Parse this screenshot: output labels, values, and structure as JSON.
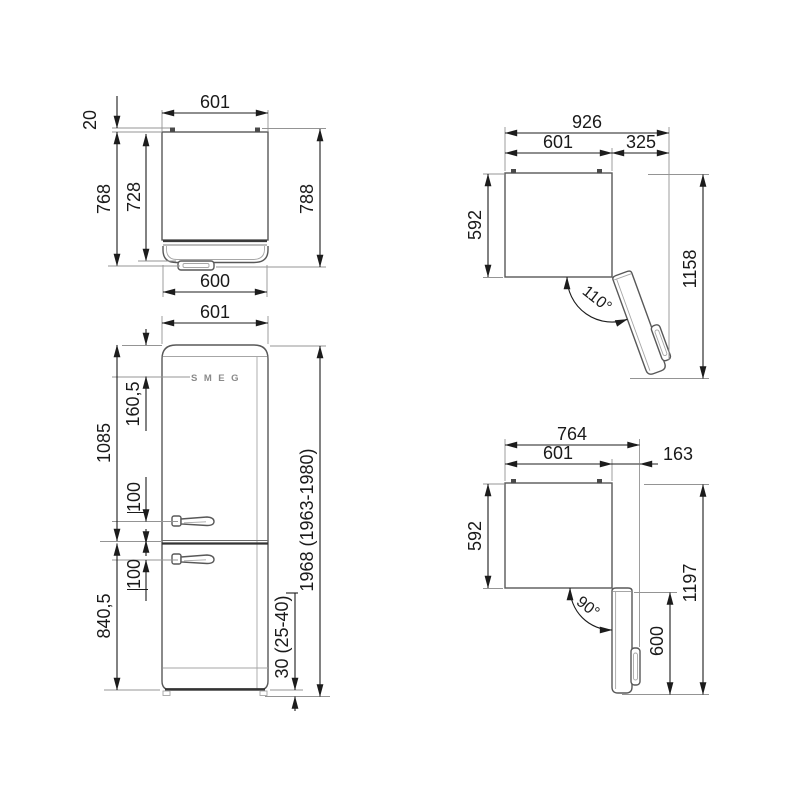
{
  "brand": "SMEG",
  "views": {
    "top": {
      "width_top": "601",
      "hinge_depth": "20",
      "depth_body": "768",
      "depth_inner": "728",
      "depth_total": "788",
      "width_bottom": "600"
    },
    "front": {
      "width": "601",
      "logo_offset": "160,5",
      "upper_section_height": "1085",
      "handle_offset_upper": "100",
      "handle_offset_lower": "100",
      "lower_section_height": "840,5",
      "plinth_height": "30 (25-40)",
      "total_height": "1968 (1963-1980)"
    },
    "door_110": {
      "total_width": "926",
      "body_width": "601",
      "door_clearance": "325",
      "body_depth": "592",
      "total_depth": "1158",
      "angle": "110°"
    },
    "door_90": {
      "total_width": "764",
      "body_width": "601",
      "door_clearance": "163",
      "body_depth": "592",
      "total_depth": "1197",
      "door_length": "600",
      "angle": "90°"
    }
  }
}
